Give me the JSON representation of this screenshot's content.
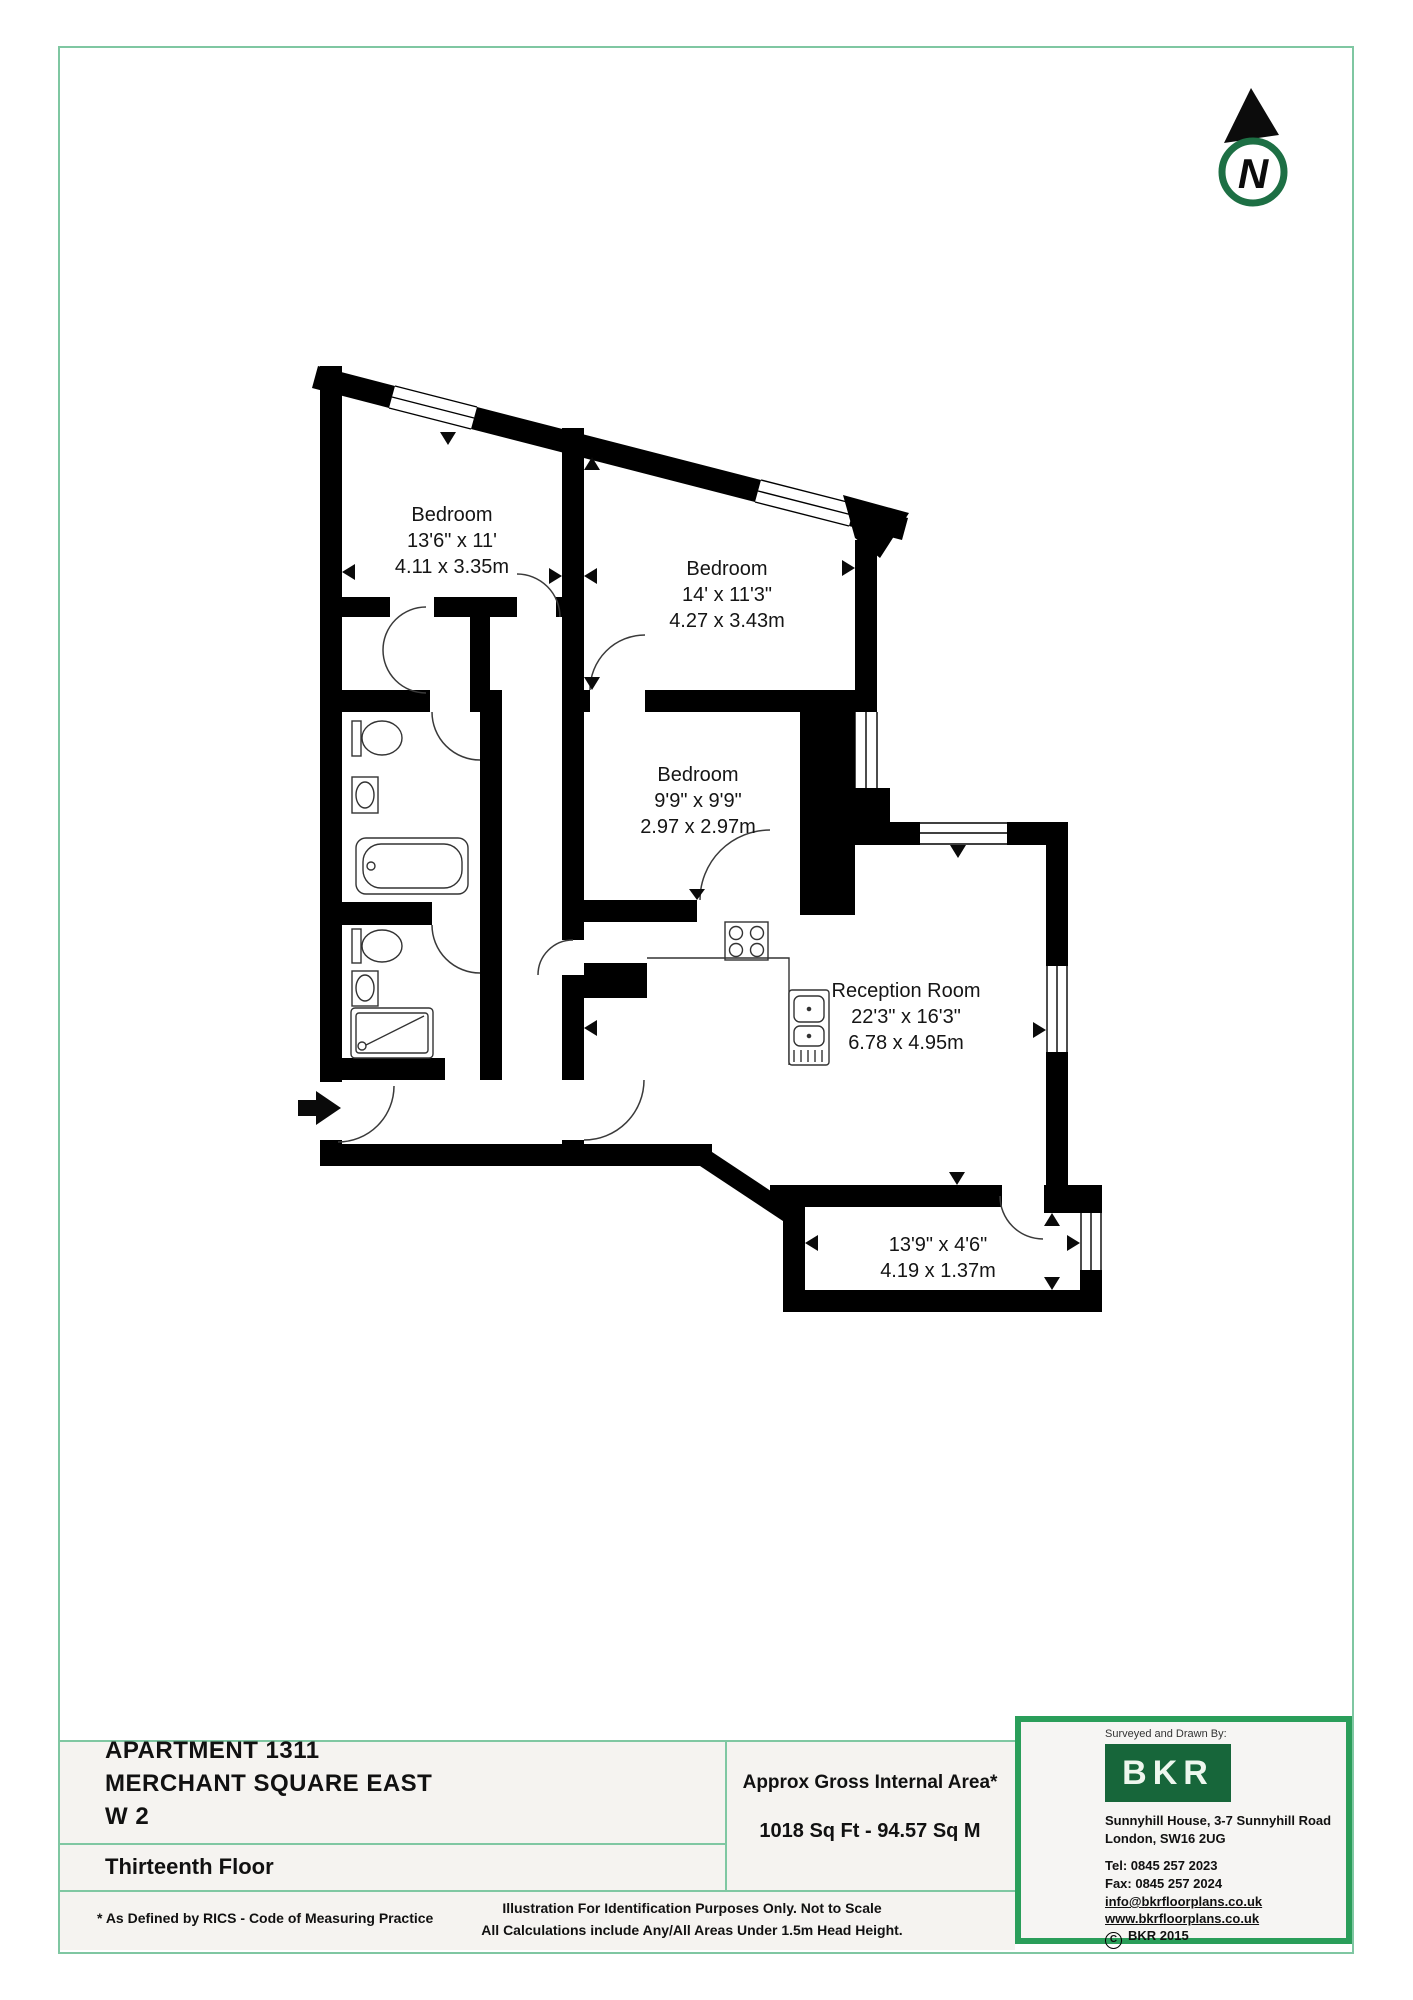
{
  "floor_plan": {
    "compass_label": "N",
    "rooms": [
      {
        "name": "Bedroom",
        "imperial": "13'6\" x 11'",
        "metric": "4.11 x 3.35m"
      },
      {
        "name": "Bedroom",
        "imperial": "14' x 11'3\"",
        "metric": "4.27 x 3.43m"
      },
      {
        "name": "Bedroom",
        "imperial": "9'9\" x 9'9\"",
        "metric": "2.97 x 2.97m"
      },
      {
        "name": "Reception Room",
        "imperial": "22'3\" x 16'3\"",
        "metric": "6.78 x 4.95m"
      },
      {
        "name": "",
        "imperial": "13'9\" x 4'6\"",
        "metric": "4.19 x 1.37m"
      }
    ]
  },
  "details": {
    "property_line1": "APARTMENT 1311",
    "property_line2": "MERCHANT SQUARE EAST",
    "property_line3": "W 2",
    "floor": "Thirteenth Floor"
  },
  "area": {
    "label": "Approx Gross Internal Area*",
    "value": "1018 Sq Ft  - 94.57 Sq M"
  },
  "footer": {
    "rics": "* As Defined by RICS - Code of Measuring Practice",
    "line1": "Illustration For Identification Purposes Only.  Not to Scale",
    "line2": "All Calculations include Any/All Areas Under 1.5m Head Height."
  },
  "surveyor": {
    "heading": "Surveyed and Drawn By:",
    "logo": "BKR",
    "address1": "Sunnyhill House, 3-7 Sunnyhill Road",
    "address2": "London, SW16 2UG",
    "tel": "Tel:  0845 257 2023",
    "fax": "Fax: 0845 257 2024",
    "email": "info@bkrfloorplans.co.uk",
    "web": "www.bkrfloorplans.co.uk",
    "copyright_c": "C",
    "copyright": "BKR 2015"
  },
  "colors": {
    "frame_green": "#7fc7a2",
    "surveyor_border_green": "#2a9e5a",
    "logo_green": "#17663a",
    "compass_green": "#1d6f44",
    "wall_black": "#000000",
    "panel_bg": "#f5f3f0"
  }
}
